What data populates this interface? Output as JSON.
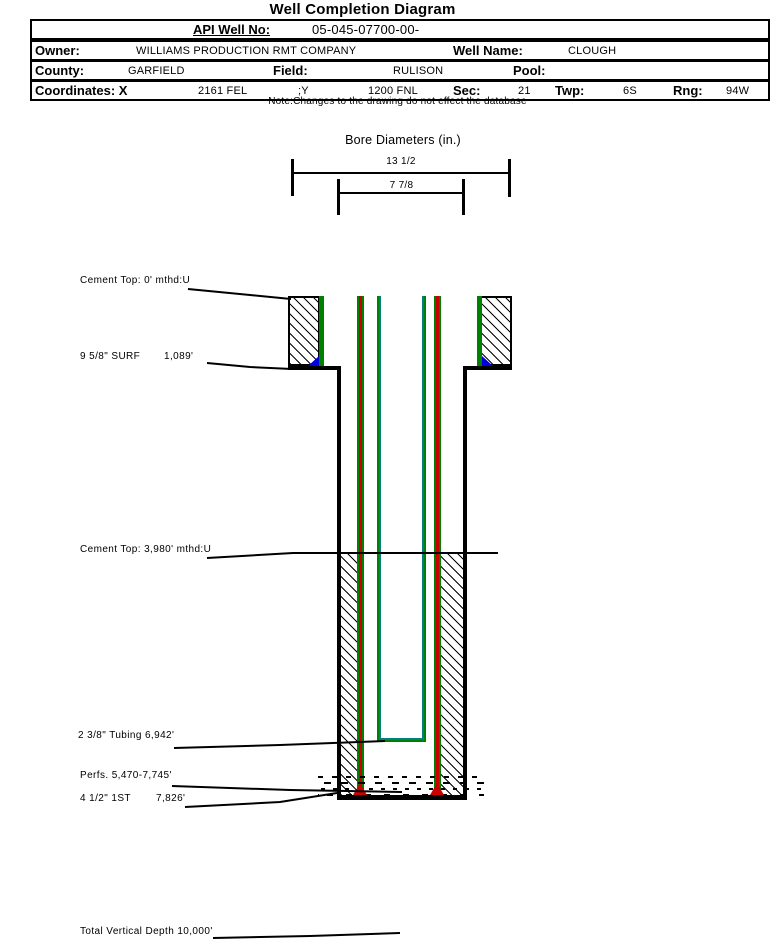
{
  "page": {
    "title": "Well Completion Diagram",
    "note": "Note:Changes to the drawing do not effect the database"
  },
  "well_info": {
    "api_label": "API Well No:",
    "api_value": "05-045-07700-00-",
    "owner_label": "Owner:",
    "owner_value": "WILLIAMS PRODUCTION RMT COMPANY",
    "well_name_label": "Well Name:",
    "well_name_value": "CLOUGH",
    "county_label": "County:",
    "county_value": "GARFIELD",
    "field_label": "Field:",
    "field_value": "RULISON",
    "pool_label": "Pool:",
    "pool_value": "",
    "coordinates_label": "Coordinates: X",
    "coordinate_x_value": "2161 FEL",
    "coordinate_y_label": ";Y",
    "coordinate_y_value": "1200 FNL",
    "sec_label": "Sec:",
    "sec_value": "21",
    "twp_label": "Twp:",
    "twp_value": "6S",
    "rng_label": "Rng:",
    "rng_value": "94W"
  },
  "bore_diameters": {
    "title": "Bore Diameters (in.)",
    "outer_label": "13 1/2",
    "inner_label": "7 7/8"
  },
  "annotations": {
    "cement_top_surface": "Cement Top: 0' mthd:U",
    "surface_casing_label": "9 5/8\" SURF",
    "surface_casing_depth": "1,089'",
    "cement_top_production": "Cement Top: 3,980' mthd:U",
    "tubing_label": "2 3/8\" Tubing 6,942'",
    "perfs_label": "Perfs. 5,470-7,745'",
    "production_casing_label": "4 1/2\" 1ST",
    "production_casing_depth": "7,826'",
    "total_vertical_depth": "Total Vertical Depth 10,000'"
  },
  "colors": {
    "casing_green": "#008000",
    "tubing_teal": "#008080",
    "shoe_red": "#cc0000",
    "shoe_blue": "#0000dd",
    "line_black": "#000000"
  }
}
